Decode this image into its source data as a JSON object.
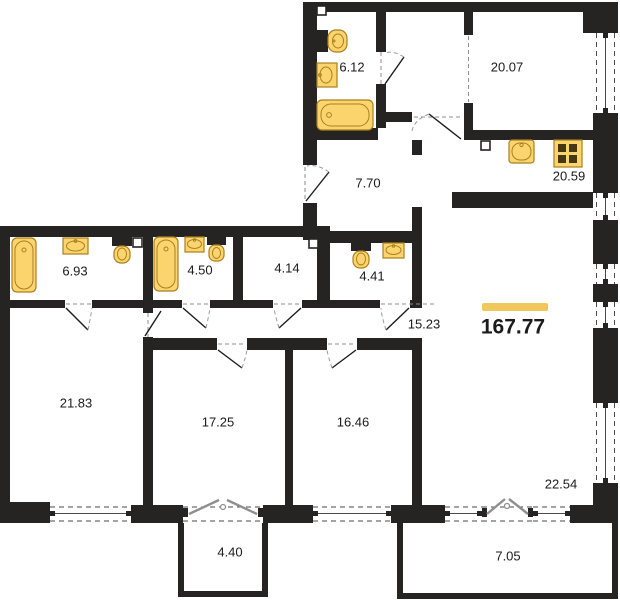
{
  "plan": {
    "total_area": "167.77",
    "rooms": [
      {
        "id": "bathroom-top",
        "area": "6.12"
      },
      {
        "id": "bedroom-top",
        "area": "20.07"
      },
      {
        "id": "hallway",
        "area": "7.70"
      },
      {
        "id": "kitchen",
        "area": "20.59"
      },
      {
        "id": "bathroom-left",
        "area": "6.93"
      },
      {
        "id": "bathroom-mid",
        "area": "4.50"
      },
      {
        "id": "storage",
        "area": "4.14"
      },
      {
        "id": "wc",
        "area": "4.41"
      },
      {
        "id": "corridor",
        "area": "15.23"
      },
      {
        "id": "bedroom-left",
        "area": "21.83"
      },
      {
        "id": "bedroom-mid",
        "area": "17.25"
      },
      {
        "id": "bedroom-right",
        "area": "16.46"
      },
      {
        "id": "living-room",
        "area": "22.54"
      },
      {
        "id": "balcony-left",
        "area": "4.40"
      },
      {
        "id": "balcony-right",
        "area": "7.05"
      }
    ],
    "fixtures": [
      {
        "type": "toilet",
        "room": "6.12"
      },
      {
        "type": "sink",
        "room": "6.12"
      },
      {
        "type": "bathtub",
        "room": "6.12"
      },
      {
        "type": "kitchen-sink",
        "room": "20.59"
      },
      {
        "type": "stove",
        "room": "20.59"
      },
      {
        "type": "bathtub",
        "room": "6.93"
      },
      {
        "type": "sink",
        "room": "6.93"
      },
      {
        "type": "toilet",
        "room": "6.93"
      },
      {
        "type": "bathtub",
        "room": "4.50"
      },
      {
        "type": "sink",
        "room": "4.50"
      },
      {
        "type": "toilet",
        "room": "4.50"
      },
      {
        "type": "toilet",
        "room": "4.41"
      },
      {
        "type": "sink",
        "room": "4.41"
      }
    ],
    "colors": {
      "wall": "#262422",
      "fixture_fill": "#FBD46D",
      "fixture_stroke": "#A8801F",
      "accent": "#F0C75A",
      "text": "#1B1B1B",
      "french_door": "#8F8F8F"
    }
  }
}
